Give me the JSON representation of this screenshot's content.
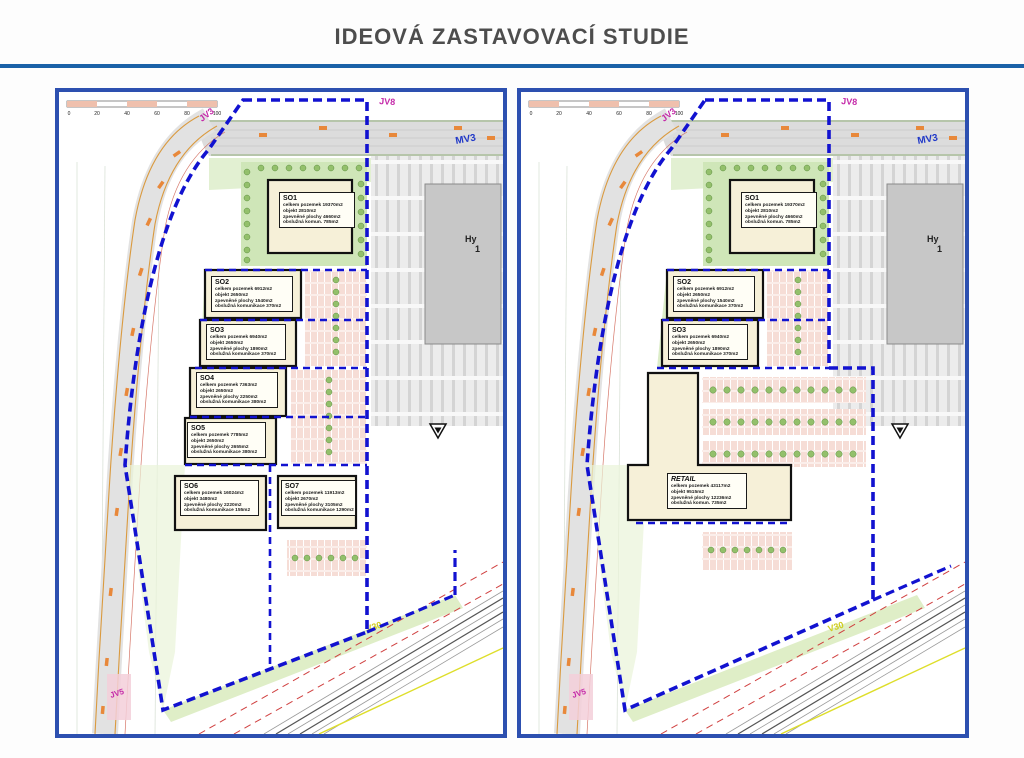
{
  "title": "IDEOVÁ ZASTAVOVACÍ STUDIE",
  "map_labels": {
    "jv8": "JV8",
    "jv3": "JV3",
    "mv3": "MV3",
    "jv5": "JV5",
    "v30": "V30",
    "hy_line1": "Hy",
    "hy_line2": "1",
    "scale": [
      "0",
      "20",
      "40",
      "60",
      "80",
      "100"
    ]
  },
  "colors": {
    "accent_blue": "#1b62a8",
    "panel_border_blue": "#2d50b0",
    "boundary_blue": "#1212d0",
    "magenta": "#c428a8",
    "road_orange": "#e8883a",
    "building_beige": "#f6f0d8"
  },
  "plans": {
    "left": {
      "buildings": [
        {
          "name": "SO1",
          "l1": "celkem pozemek 19370m2",
          "l2": "objekt 2810m2",
          "l3": "zpevněné plochy 4660m2",
          "l4": "obslužná komun. 785m2"
        },
        {
          "name": "SO2",
          "l1": "celkem pozemek 6912m2",
          "l2": "objekt 2650m2",
          "l3": "zpevněné plochy 1540m2",
          "l4": "obslužná komunikace 370m2"
        },
        {
          "name": "SO3",
          "l1": "celkem pozemek 6940m2",
          "l2": "objekt 2650m2",
          "l3": "zpevněné plochy 1890m2",
          "l4": "obslužná komunikace 370m2"
        },
        {
          "name": "SO4",
          "l1": "celkem pozemek 7363m2",
          "l2": "objekt 2650m2",
          "l3": "zpevněné plochy 2250m2",
          "l4": "obslužná komunikace 380m2"
        },
        {
          "name": "SO5",
          "l1": "celkem pozemek 7785m2",
          "l2": "objekt 2650m2",
          "l3": "zpevněné plochy 2655m2",
          "l4": "obslužná komunikace 380m2"
        },
        {
          "name": "SO6",
          "l1": "celkem pozemek 16024m2",
          "l2": "objekt 3480m2",
          "l3": "zpevněné plochy 2220m2",
          "l4": "obslužná komunikace 155m2"
        },
        {
          "name": "SO7",
          "l1": "celkem pozemek 11913m2",
          "l2": "objekt 2670m2",
          "l3": "zpevněné plochy 3105m2",
          "l4": "obslužná komunikace 1290m2"
        }
      ]
    },
    "right": {
      "buildings": [
        {
          "name": "SO1",
          "l1": "celkem pozemek 19370m2",
          "l2": "objekt 2810m2",
          "l3": "zpevněné plochy 4660m2",
          "l4": "obslužná komun. 785m2"
        },
        {
          "name": "SO2",
          "l1": "celkem pozemek 6912m2",
          "l2": "objekt 2650m2",
          "l3": "zpevněné plochy 1540m2",
          "l4": "obslužná komunikace 370m2"
        },
        {
          "name": "SO3",
          "l1": "celkem pozemek 6940m2",
          "l2": "objekt 2650m2",
          "l3": "zpevněné plochy 1890m2",
          "l4": "obslužná komunikace 370m2"
        },
        {
          "name": "RETAIL",
          "l1": "celkem pozemek 43117m2",
          "l2": "objekt 9515m2",
          "l3": "zpevněné plochy 12236m2",
          "l4": "obslužná komun. 735m2"
        }
      ]
    }
  }
}
